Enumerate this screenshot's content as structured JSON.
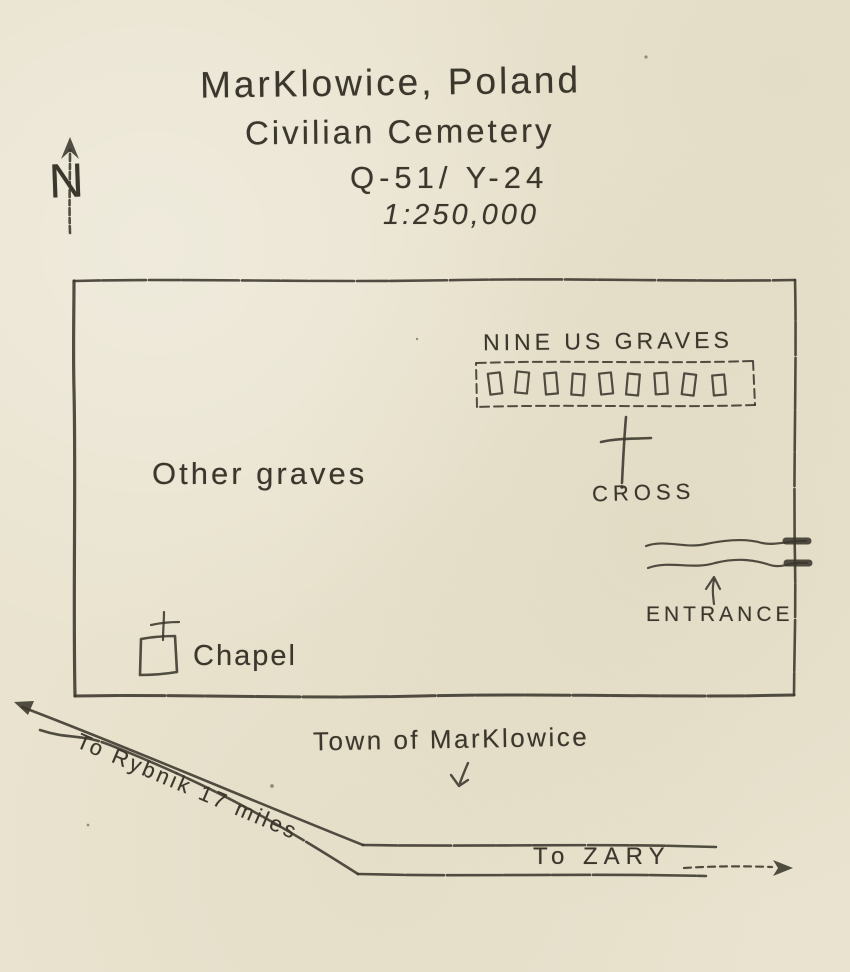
{
  "colors": {
    "paper": "#e9e3cf",
    "ink": "#3b372c"
  },
  "compass": {
    "label": "N"
  },
  "title": {
    "line1": "MarKlowice, Poland",
    "line2": "Civilian Cemetery",
    "line3": "Q-51/ Y-24",
    "line4": "1:250,000"
  },
  "cemetery": {
    "us_graves_label": "NINE US GRAVES",
    "us_graves_count": 9,
    "cross_label": "CROSS",
    "other_graves_label": "Other graves",
    "entrance_label": "ENTRANCE",
    "chapel_label": "Chapel"
  },
  "surroundings": {
    "town_label": "Town of MarKlowice",
    "road_rybnik_label": "To Rybnik 17 miles",
    "road_zary_label": "To ZARY"
  }
}
